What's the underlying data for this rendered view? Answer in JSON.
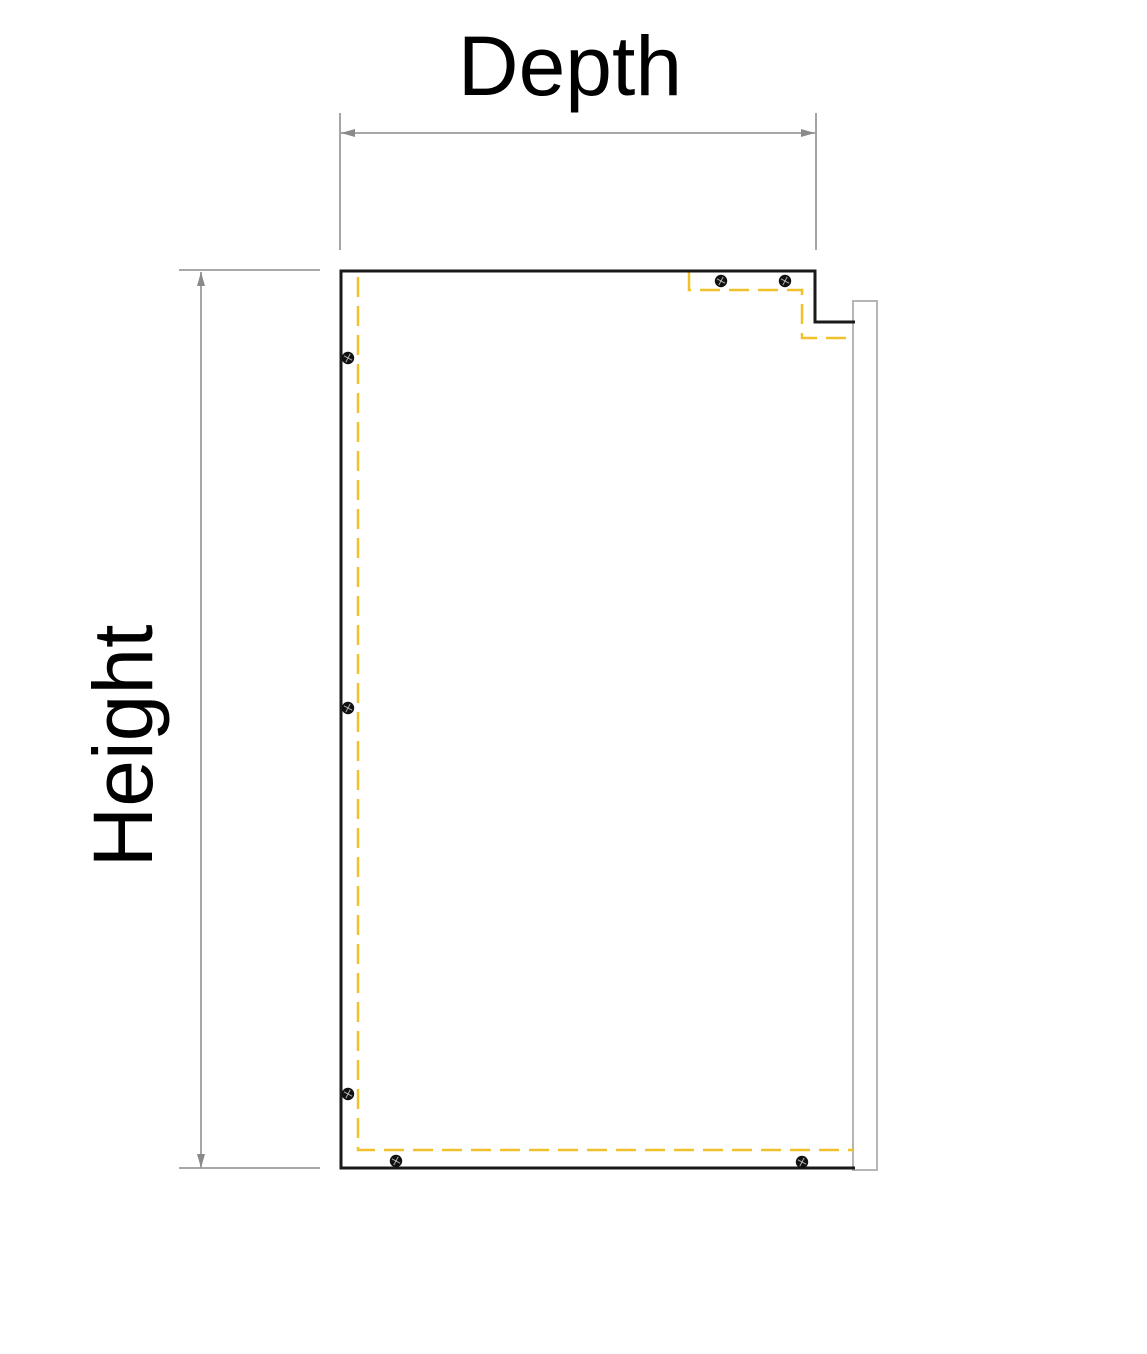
{
  "labels": {
    "depth": "Depth",
    "height": "Height"
  },
  "colors": {
    "outline": "#1a1a1a",
    "hidden_line": "#f0c12b",
    "dimension_line": "#9b9b9b",
    "arrow_fill": "#8a8a8a",
    "wall_panel_stroke": "#b5b5b5",
    "wall_panel_fill": "#ffffff",
    "screw_fill": "#111111",
    "screw_detail": "#ffffff",
    "background": "#ffffff"
  },
  "geometry": {
    "viewbox": "0 0 1147 1354",
    "side_panel_outline_path": "M855,322 L815,322 L815,271 L341,271 L341,1168 L855,1168",
    "hidden_line_paths": [
      "M358,277 L358,1150 L853,1150",
      "M689,272 L689,290 L802,290 L802,338 L853,338"
    ],
    "hidden_dash_pattern": "20 9",
    "wall_panel_rect": {
      "x": 853,
      "y": 301,
      "width": 24,
      "height": 869
    },
    "dimension_lines": [
      {
        "x1": 341,
        "y1": 133,
        "x2": 815,
        "y2": 133
      },
      {
        "x1": 201,
        "y1": 272,
        "x2": 201,
        "y2": 1168
      }
    ],
    "extension_lines": [
      {
        "x1": 340,
        "y1": 113,
        "x2": 340,
        "y2": 250
      },
      {
        "x1": 816,
        "y1": 113,
        "x2": 816,
        "y2": 250
      },
      {
        "x1": 179,
        "y1": 270,
        "x2": 320,
        "y2": 270
      },
      {
        "x1": 179,
        "y1": 1168,
        "x2": 320,
        "y2": 1168
      }
    ],
    "arrowheads": [
      "341,133 355,129 355,137",
      "815,133 801,129 801,137",
      "201,272 197,286 205,286",
      "201,1168 197,1154 205,1154"
    ],
    "screws": [
      {
        "cx": 348,
        "cy": 358
      },
      {
        "cx": 348,
        "cy": 708
      },
      {
        "cx": 348,
        "cy": 1094
      },
      {
        "cx": 721,
        "cy": 281
      },
      {
        "cx": 785,
        "cy": 281
      },
      {
        "cx": 396,
        "cy": 1161
      },
      {
        "cx": 802,
        "cy": 1162
      }
    ],
    "screw_radius": 6.2
  }
}
